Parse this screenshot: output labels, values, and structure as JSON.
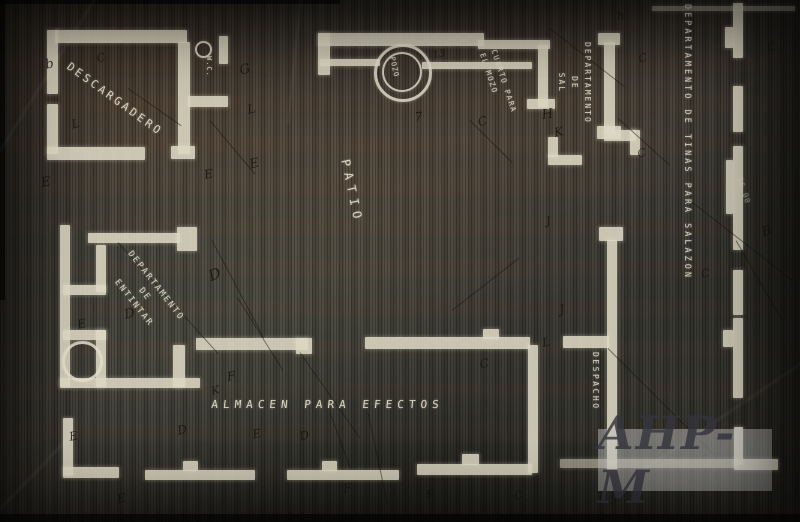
{
  "rooms": {
    "descargadero": {
      "label": "DESCARGADERO"
    },
    "wc": {
      "label": "W.C."
    },
    "pozo": {
      "label": "POZO"
    },
    "cuarto_mozo": {
      "line1": "CUARTO PARA",
      "line2": "EL MOZO"
    },
    "sal": {
      "line1": "DEPARTAMENTO",
      "line2": "DE",
      "line3": "SAL"
    },
    "tinas": {
      "label": "DEPARTAMENTO DE TINAS PARA SALAZON"
    },
    "patio": {
      "label": "PATIO"
    },
    "entintar": {
      "line1": "DEPARTAMENTO",
      "line2": "DE",
      "line3": "ENTINTAR"
    },
    "almacen": {
      "label": "ALMACEN PARA EFECTOS"
    },
    "despacho": {
      "label": "DESPACHO"
    }
  },
  "watermark": {
    "text": "AHP-M"
  },
  "annotations": {
    "dimension": "16.00",
    "pencil_marks": [
      {
        "t": "b",
        "x": 44,
        "y": 58,
        "r": -12,
        "s": 13
      },
      {
        "t": "C",
        "x": 95,
        "y": 53,
        "r": -18,
        "s": 11
      },
      {
        "t": "E",
        "x": 40,
        "y": 176,
        "r": -10,
        "s": 13
      },
      {
        "t": "L",
        "x": 70,
        "y": 118,
        "r": -14,
        "s": 12
      },
      {
        "t": "G",
        "x": 238,
        "y": 64,
        "r": -15,
        "s": 13
      },
      {
        "t": "L",
        "x": 246,
        "y": 103,
        "r": -12,
        "s": 12
      },
      {
        "t": "E",
        "x": 248,
        "y": 158,
        "r": -14,
        "s": 13
      },
      {
        "t": "E",
        "x": 203,
        "y": 168,
        "r": -10,
        "s": 12
      },
      {
        "t": "13",
        "x": 432,
        "y": 50,
        "r": -8,
        "s": 10
      },
      {
        "t": "7",
        "x": 414,
        "y": 110,
        "r": -5,
        "s": 12
      },
      {
        "t": "C",
        "x": 476,
        "y": 116,
        "r": -18,
        "s": 12
      },
      {
        "t": "H",
        "x": 541,
        "y": 108,
        "r": -8,
        "s": 13
      },
      {
        "t": "K",
        "x": 553,
        "y": 126,
        "r": -12,
        "s": 12
      },
      {
        "t": "C",
        "x": 637,
        "y": 53,
        "r": -15,
        "s": 11
      },
      {
        "t": "C",
        "x": 636,
        "y": 148,
        "r": -15,
        "s": 11
      },
      {
        "t": "C",
        "x": 766,
        "y": 42,
        "r": -12,
        "s": 11
      },
      {
        "t": "B",
        "x": 760,
        "y": 226,
        "r": -18,
        "s": 13
      },
      {
        "t": "J",
        "x": 558,
        "y": 303,
        "r": -12,
        "s": 12
      },
      {
        "t": "L",
        "x": 541,
        "y": 336,
        "r": -10,
        "s": 12
      },
      {
        "t": "C",
        "x": 478,
        "y": 358,
        "r": -15,
        "s": 12
      },
      {
        "t": "D",
        "x": 206,
        "y": 268,
        "r": -20,
        "s": 15
      },
      {
        "t": "D",
        "x": 123,
        "y": 308,
        "r": -12,
        "s": 13
      },
      {
        "t": "E",
        "x": 76,
        "y": 318,
        "r": -12,
        "s": 12
      },
      {
        "t": "F",
        "x": 226,
        "y": 370,
        "r": -10,
        "s": 12
      },
      {
        "t": "E",
        "x": 251,
        "y": 428,
        "r": -12,
        "s": 12
      },
      {
        "t": "D",
        "x": 176,
        "y": 424,
        "r": -12,
        "s": 12
      },
      {
        "t": "F",
        "x": 342,
        "y": 482,
        "r": -10,
        "s": 12
      },
      {
        "t": "E",
        "x": 116,
        "y": 492,
        "r": -10,
        "s": 12
      },
      {
        "t": "C",
        "x": 513,
        "y": 490,
        "r": -12,
        "s": 11
      },
      {
        "t": "F",
        "x": 425,
        "y": 488,
        "r": -10,
        "s": 12
      },
      {
        "t": "E",
        "x": 68,
        "y": 430,
        "r": -10,
        "s": 12
      },
      {
        "t": "D",
        "x": 298,
        "y": 430,
        "r": -14,
        "s": 12
      },
      {
        "t": "K",
        "x": 210,
        "y": 385,
        "r": -12,
        "s": 11
      },
      {
        "t": "J",
        "x": 545,
        "y": 215,
        "r": -10,
        "s": 11
      },
      {
        "t": "C",
        "x": 700,
        "y": 268,
        "r": -12,
        "s": 11
      },
      {
        "t": "h",
        "x": 616,
        "y": 10,
        "r": -10,
        "s": 11
      }
    ]
  },
  "colors": {
    "background": "#45413a",
    "wall": "#ded9c4",
    "label": "#d8d3bf",
    "pencil": "#16130d",
    "watermark_box": "#c4c4c2",
    "watermark_text": "#34343e"
  }
}
